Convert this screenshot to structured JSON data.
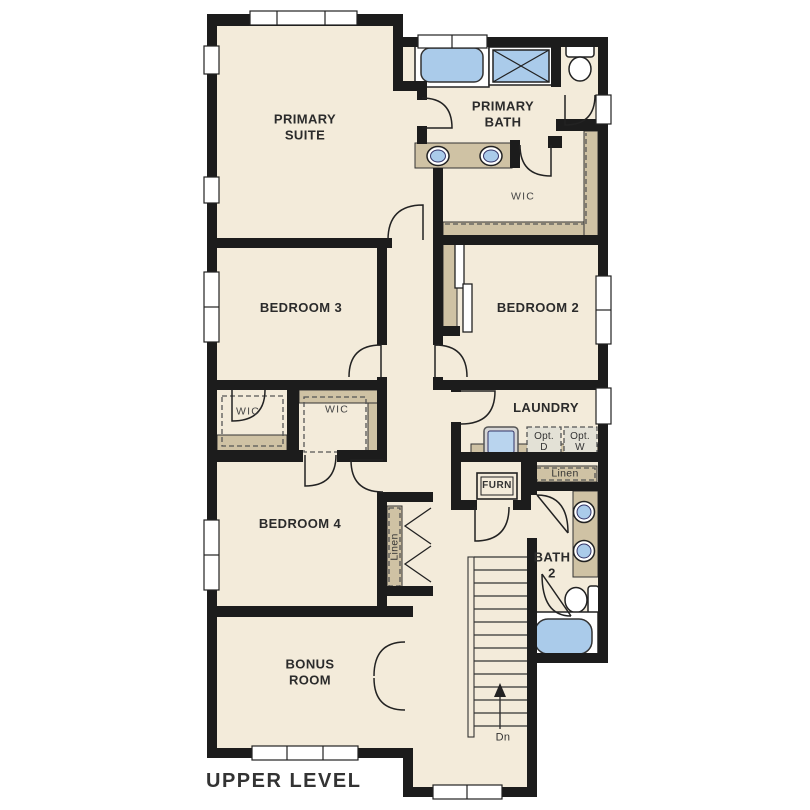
{
  "title": "UPPER LEVEL",
  "colors": {
    "wall": "#1c1c1c",
    "floor": "#f3ebda",
    "shelf_tan": "#cfc2a4",
    "fixture_blue": "#aacbea",
    "fixture_blue_light": "#b9d4ee",
    "outline": "#222222",
    "dashed": "#555555",
    "optional_fill": "#e3e1d6",
    "text": "#2b2b2b"
  },
  "rooms": {
    "primary_suite": {
      "l1": "PRIMARY",
      "l2": "SUITE"
    },
    "primary_bath": {
      "l1": "PRIMARY",
      "l2": "BATH"
    },
    "primary_wic": "WIC",
    "bedroom3": "BEDROOM 3",
    "bedroom2": "BEDROOM 2",
    "wic_bedroom3": "WIC",
    "wic_bedroom4": "WIC",
    "laundry": "LAUNDRY",
    "opt_dryer": {
      "l1": "Opt.",
      "l2": "D"
    },
    "opt_washer": {
      "l1": "Opt.",
      "l2": "W"
    },
    "furnace": "FURN",
    "linen_bath2": "Linen",
    "bedroom4": "BEDROOM 4",
    "linen_hall": "Linen",
    "bath2": {
      "l1": "BATH",
      "l2": "2"
    },
    "bonus": {
      "l1": "BONUS",
      "l2": "ROOM"
    },
    "stairs_down": "Dn"
  }
}
